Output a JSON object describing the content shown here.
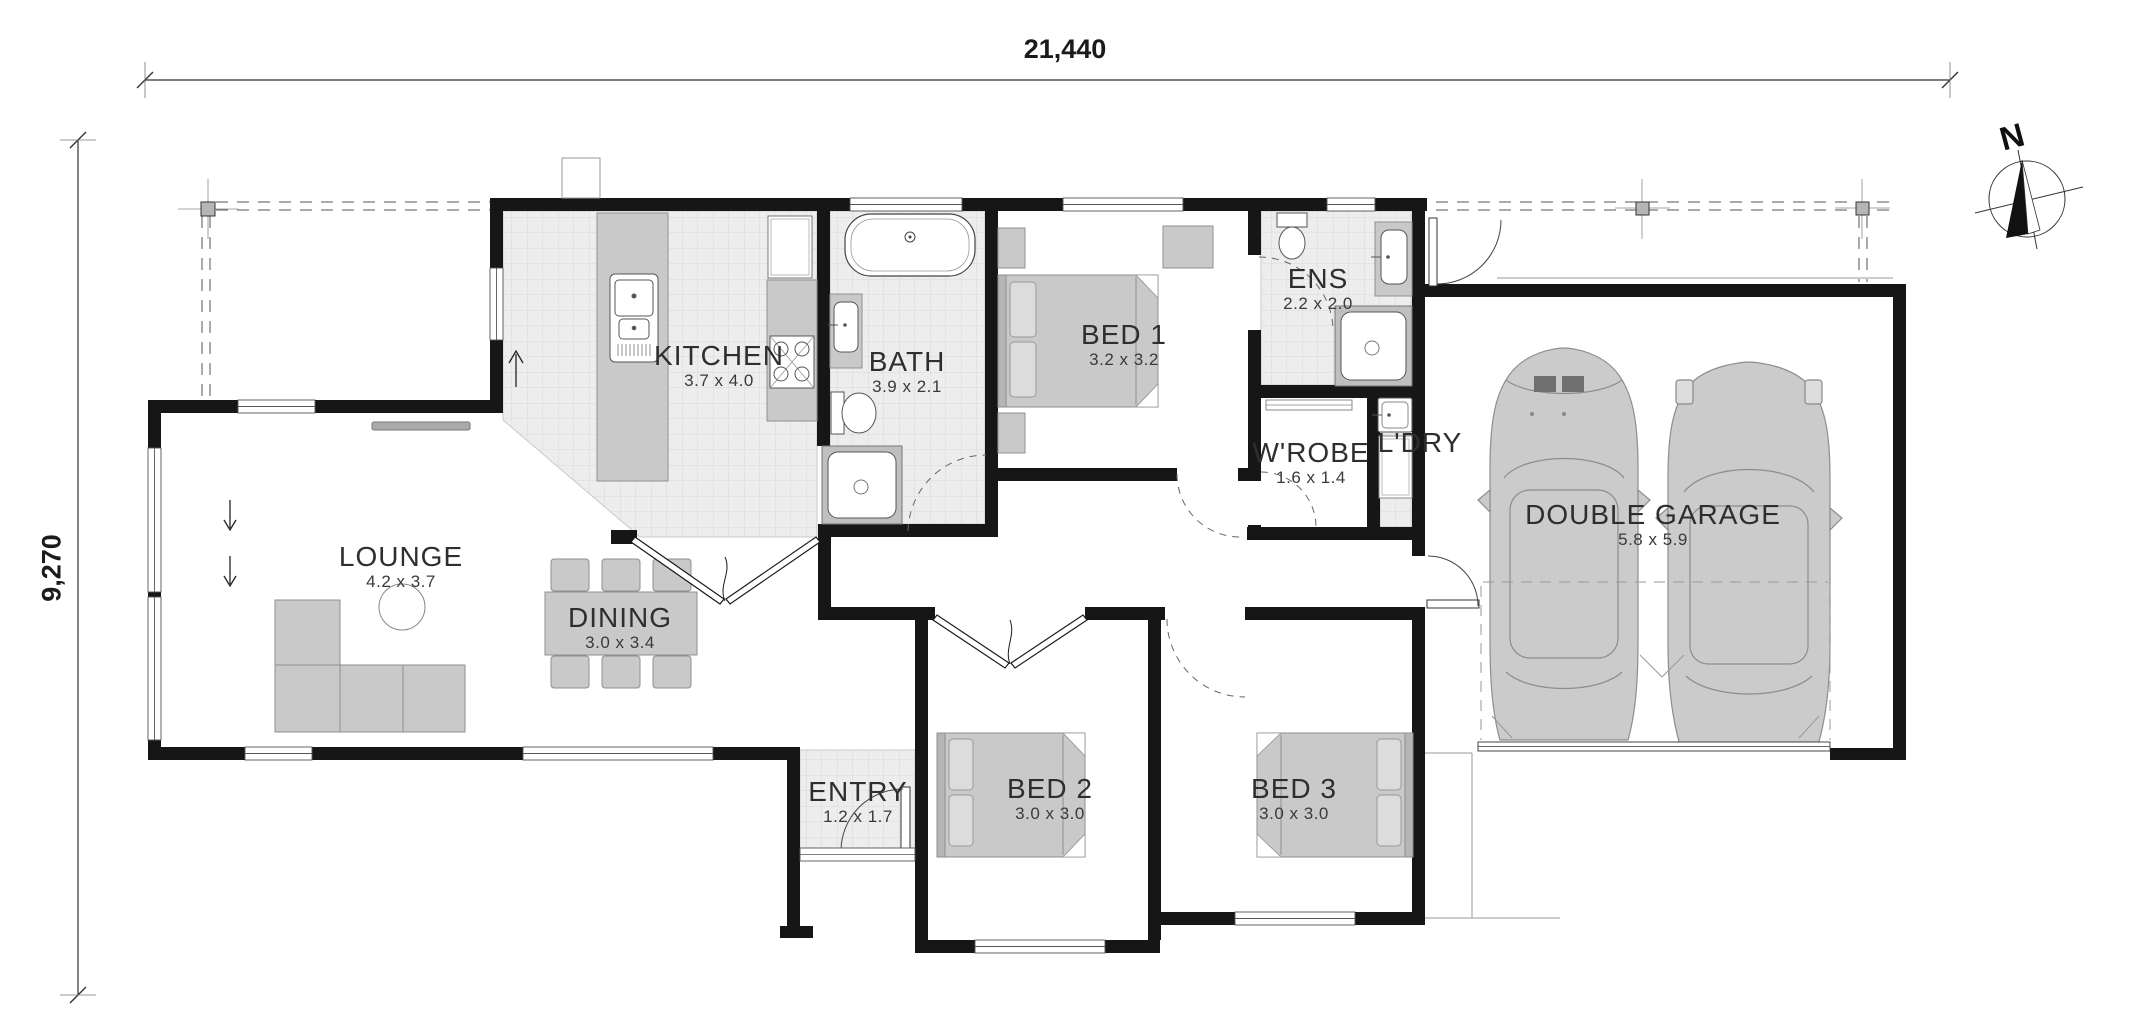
{
  "dimensions": {
    "width": "21,440",
    "height": "9,270"
  },
  "compass": {
    "label": "N"
  },
  "rooms": [
    {
      "id": "kitchen",
      "name": "KITCHEN",
      "dims": "3.7 x 4.0"
    },
    {
      "id": "bath",
      "name": "BATH",
      "dims": "3.9 x 2.1"
    },
    {
      "id": "bed1",
      "name": "BED 1",
      "dims": "3.2 x 3.2"
    },
    {
      "id": "ens",
      "name": "ENS",
      "dims": "2.2 x 2.0"
    },
    {
      "id": "wrobe",
      "name": "W'ROBE",
      "dims": "1.6 x 1.4"
    },
    {
      "id": "ldry",
      "name": "L'DRY",
      "dims": ""
    },
    {
      "id": "garage",
      "name": "DOUBLE GARAGE",
      "dims": "5.8 x 5.9"
    },
    {
      "id": "lounge",
      "name": "LOUNGE",
      "dims": "4.2 x 3.7"
    },
    {
      "id": "dining",
      "name": "DINING",
      "dims": "3.0 x 3.4"
    },
    {
      "id": "entry",
      "name": "ENTRY",
      "dims": "1.2 x 1.7"
    },
    {
      "id": "bed2",
      "name": "BED 2",
      "dims": "3.0 x 3.0"
    },
    {
      "id": "bed3",
      "name": "BED 3",
      "dims": "3.0 x 3.0"
    }
  ]
}
